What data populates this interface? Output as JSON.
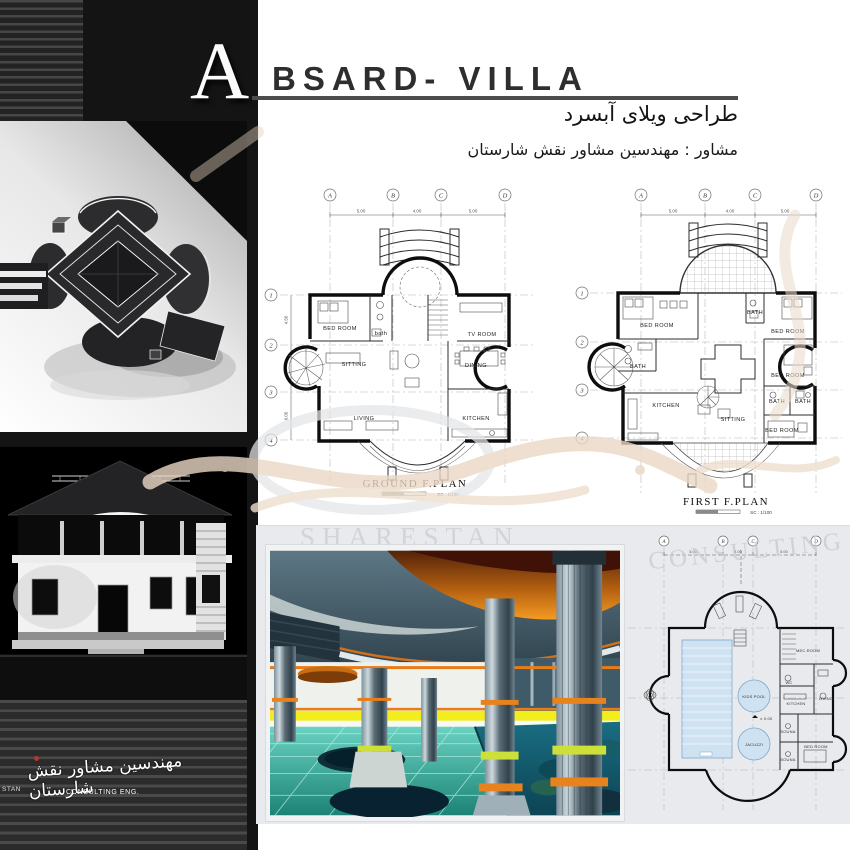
{
  "header": {
    "letter": "A",
    "title": "BSARD- VILLA",
    "subtitle_fa": "طراحی ویلای آبسرد",
    "consultant_fa": "مشاور : مهندسین مشاور نقش شارستان"
  },
  "plans": {
    "ground": {
      "title": "GROUND F.PLAN",
      "scale": "SC : 1/100",
      "grid_cols": [
        "A",
        "B",
        "C",
        "D"
      ],
      "grid_rows": [
        "1",
        "2",
        "3",
        "4"
      ],
      "dims_top": [
        "5.00",
        "4.00",
        "5.00"
      ],
      "dims_side": [
        "4.50",
        "6.00"
      ],
      "rooms": {
        "bedroom": "BED ROOM",
        "bath": "bath",
        "tvroom": "TV ROOM",
        "sitting": "SITTING",
        "dining": "DINING",
        "living": "LIVING",
        "kitchen": "KITCHEN"
      }
    },
    "first": {
      "title": "FIRST F.PLAN",
      "scale": "SC : 1/100",
      "grid_cols": [
        "A",
        "B",
        "C",
        "D"
      ],
      "grid_rows": [
        "1",
        "2",
        "3",
        "4"
      ],
      "dims_top": [
        "5.00",
        "4.00",
        "5.00"
      ],
      "rooms": {
        "bedroom_tl": "BED ROOM",
        "bath_left": "BATH",
        "bath_center": "BATH",
        "bedroom_tr": "BED ROOM",
        "bedroom_right": "BED ROOM",
        "bath_r1": "BATH",
        "bath_r2": "BATH",
        "bedroom_br": "BED ROOM",
        "kitchen": "KITCHEN",
        "sitting": "SITTING"
      }
    },
    "basement": {
      "grid_cols": [
        "A",
        "B",
        "C",
        "D"
      ],
      "dims_top": [
        "5.00",
        "4.00",
        "5.00"
      ],
      "level": "± 0.00",
      "rooms": {
        "mec_room": "MEC.ROOM",
        "kids_pool": "KIDS POOL",
        "jacuzzi": "JACUZZI",
        "kitchen": "KITCHEN",
        "wc": "WC",
        "living": "LIVING",
        "souna1": "SOUNA",
        "souna2": "SOUNA",
        "bedroom": "BED ROOM"
      }
    }
  },
  "logo": {
    "script_fa": "مهندسین مشاور نقش شارستان",
    "left_fragment": "STAN",
    "consulting": "CONSULTING ENG."
  },
  "watermarks": {
    "sharestan": "SHARESTAN",
    "consulting": "CONSULTING"
  },
  "palette": {
    "sidebar_black": "#141414",
    "panel_gray": "#e8eaed",
    "pool_orange": "#ef8d1a",
    "pool_yellow": "#f2ee1e",
    "pool_teal": "#2fa99a",
    "ceiling_slate": "#4e6570",
    "plan_pool_blue": "#cfe2f2",
    "title_gray": "#2e2e2e",
    "watermark_tan": "#ead8c6"
  }
}
